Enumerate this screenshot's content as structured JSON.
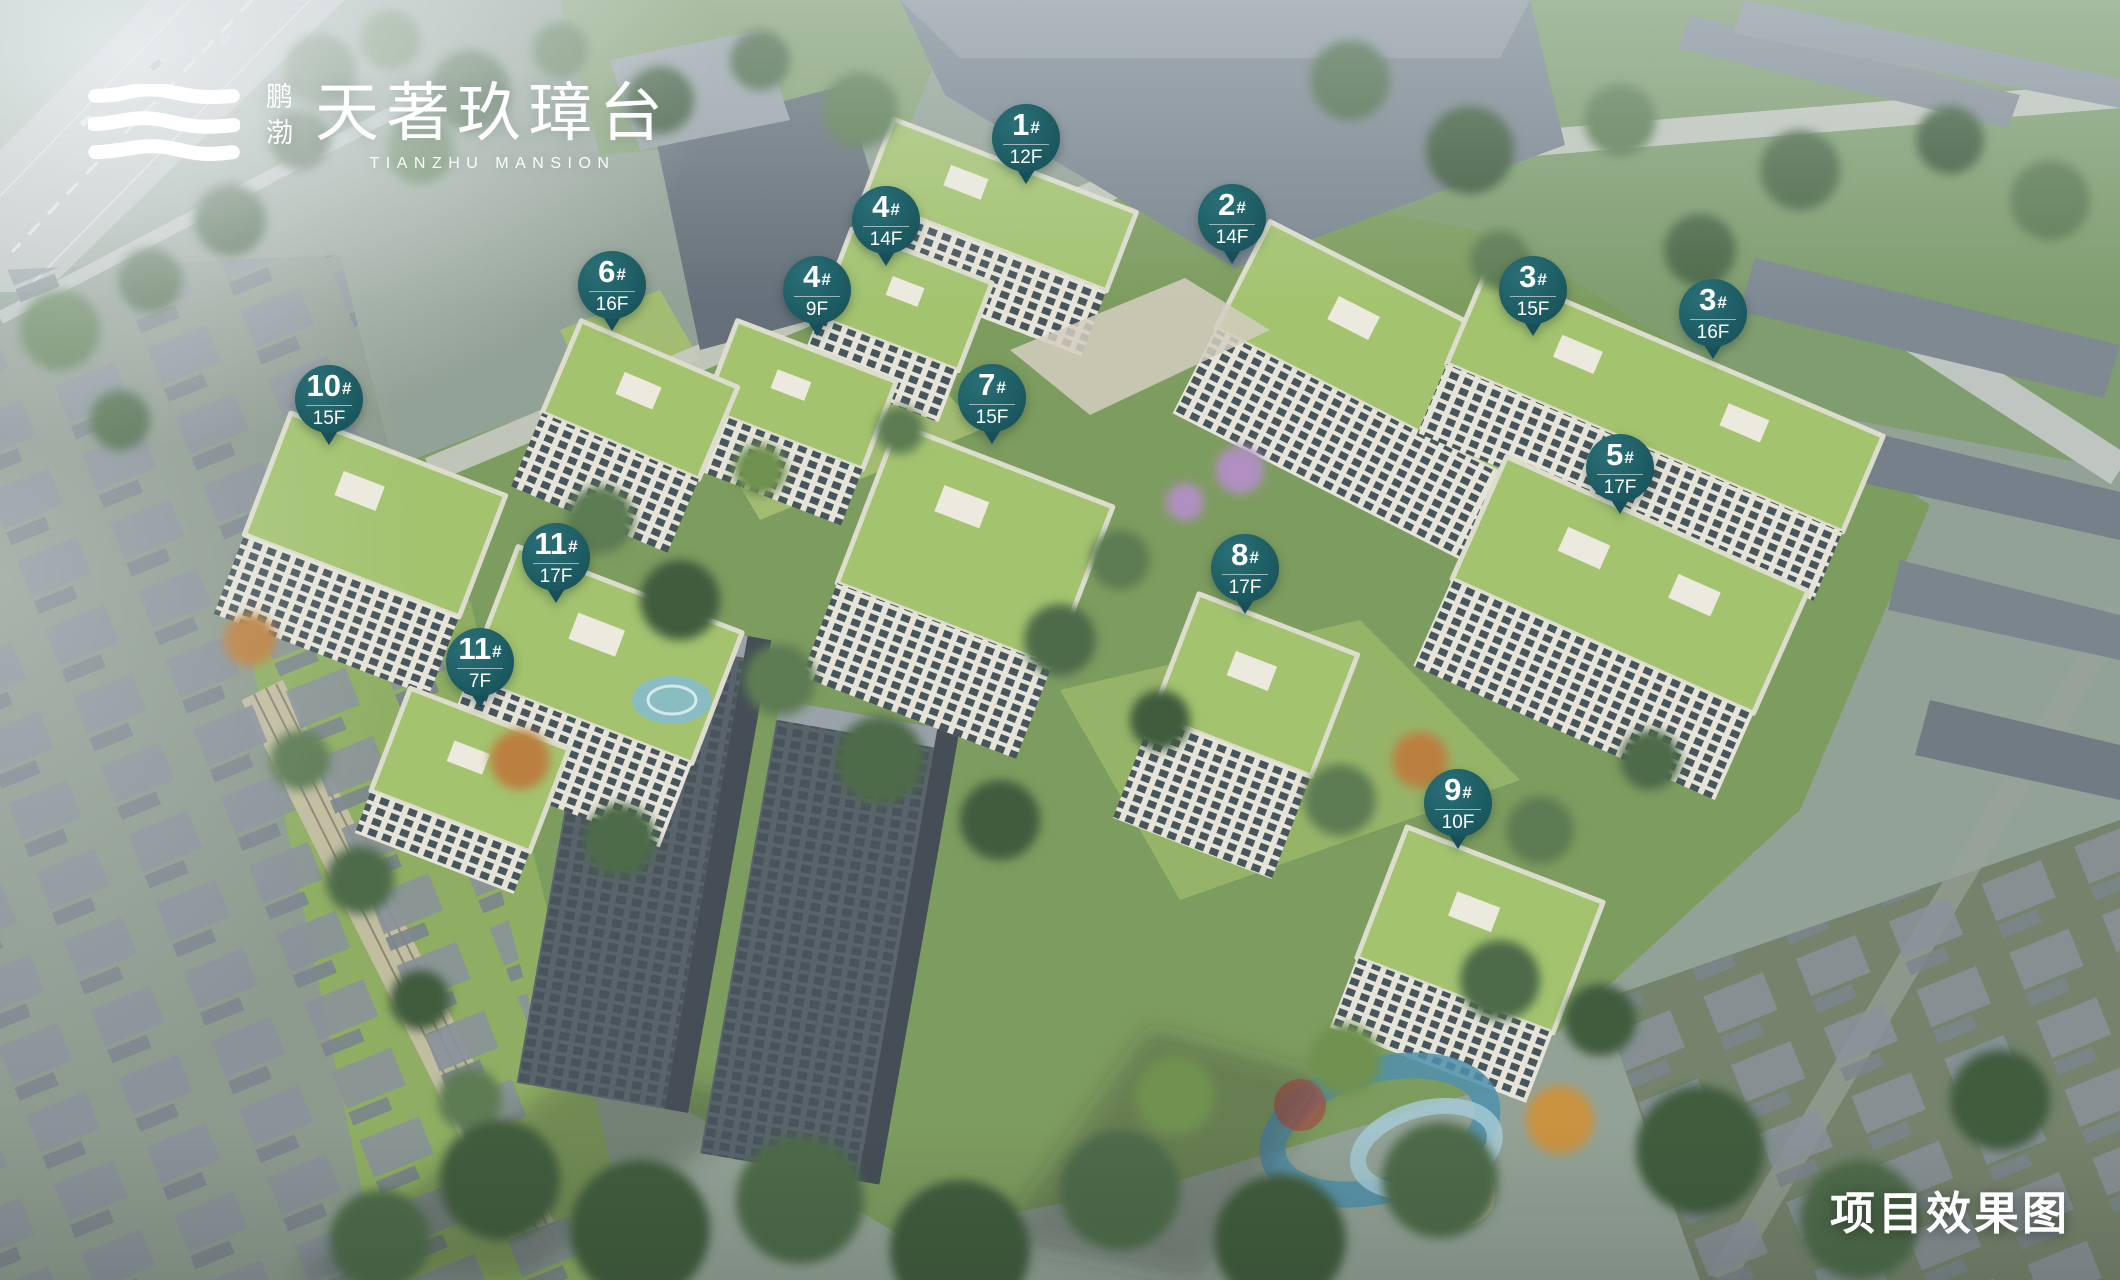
{
  "logo": {
    "brand_cn_vertical": "鹏渤",
    "brand_cn_main": "天著玖璋台",
    "brand_en": "TIANZHU MANSION"
  },
  "caption": "项目效果图",
  "colors": {
    "marker_teal": "#1d5c63",
    "roof_green": "#a3c36f",
    "logo_white": "#ffffff"
  },
  "markers": [
    {
      "building": "1#",
      "floors": "12F",
      "x": 1026,
      "y": 138
    },
    {
      "building": "4#",
      "floors": "14F",
      "x": 886,
      "y": 220
    },
    {
      "building": "2#",
      "floors": "14F",
      "x": 1232,
      "y": 218
    },
    {
      "building": "6#",
      "floors": "16F",
      "x": 612,
      "y": 285
    },
    {
      "building": "4#",
      "floors": "9F",
      "x": 817,
      "y": 290
    },
    {
      "building": "3#",
      "floors": "15F",
      "x": 1533,
      "y": 290
    },
    {
      "building": "3#",
      "floors": "16F",
      "x": 1713,
      "y": 313
    },
    {
      "building": "10#",
      "floors": "15F",
      "x": 329,
      "y": 399
    },
    {
      "building": "7#",
      "floors": "15F",
      "x": 992,
      "y": 398
    },
    {
      "building": "5#",
      "floors": "17F",
      "x": 1620,
      "y": 468
    },
    {
      "building": "11#",
      "floors": "17F",
      "x": 556,
      "y": 557
    },
    {
      "building": "8#",
      "floors": "17F",
      "x": 1245,
      "y": 568
    },
    {
      "building": "11#",
      "floors": "7F",
      "x": 480,
      "y": 662
    },
    {
      "building": "9#",
      "floors": "10F",
      "x": 1458,
      "y": 803
    }
  ]
}
